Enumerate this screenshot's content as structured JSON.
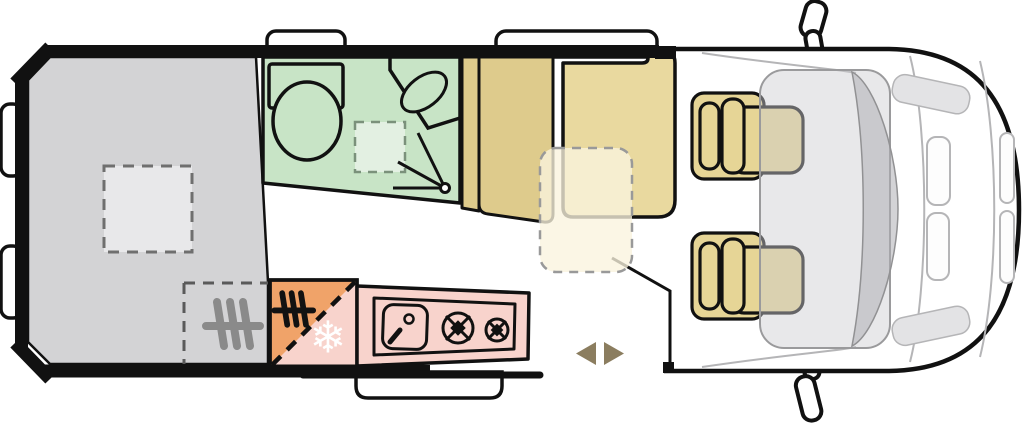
{
  "diagram": {
    "type": "campervan-floorplan",
    "orientation": "vehicle front on the right, rear on the left, top-down view",
    "glyphs": {
      "snowflake": "❄"
    },
    "colors": {
      "bed_area": "#d3d3d5",
      "skylight": "#e8e8ea",
      "bathroom": "#c8e4c6",
      "shower_tray": "#e3f0e2",
      "wardrobe": "#decb8c",
      "bench_seat": "#e9d99f",
      "table_fill": "#f8f1da",
      "cab_seat": "#e6d596",
      "kitchen_pink": "#f8d3cc",
      "fridge_orange": "#f0a369",
      "arrow_olive": "#8b7d5f",
      "dashboard_gray": "#dcdcde",
      "outline_black": "#111111",
      "detail_gray": "#b5b5b7",
      "heater_icon_gray": "#8a8a8a"
    },
    "zones": [
      {
        "id": "rear-bed",
        "desc": "transverse rear bed"
      },
      {
        "id": "roof-skylight-rear",
        "desc": "roof skylight above bed, dashed outline"
      },
      {
        "id": "heater-zone",
        "desc": "heater position under bed, dashed outline with heater icon"
      },
      {
        "id": "bathroom",
        "desc": "washroom with toilet, corner washbasin, shower tray and pivot door"
      },
      {
        "id": "wardrobe",
        "desc": "wardrobe cabinet beside washroom"
      },
      {
        "id": "dinette-bench",
        "desc": "forward travel bench seat"
      },
      {
        "id": "table",
        "desc": "removable table shown dashed"
      },
      {
        "id": "kitchen",
        "desc": "kitchen unit with sink and two-burner hob"
      },
      {
        "id": "fridge-heater-cabinet",
        "desc": "cabinet split diagonally: heater icon on orange, snowflake fridge on pink"
      },
      {
        "id": "entry-step",
        "desc": "entry step below sliding door"
      },
      {
        "id": "sliding-door",
        "desc": "sliding side door with left/right arrows"
      },
      {
        "id": "cab",
        "desc": "driver cab with two seats, dashboard, windscreen and mirrors"
      },
      {
        "id": "roof-windows",
        "desc": "two roof windows along the top wall"
      },
      {
        "id": "rear-doors",
        "desc": "rear door handles at the back of the van"
      }
    ]
  }
}
